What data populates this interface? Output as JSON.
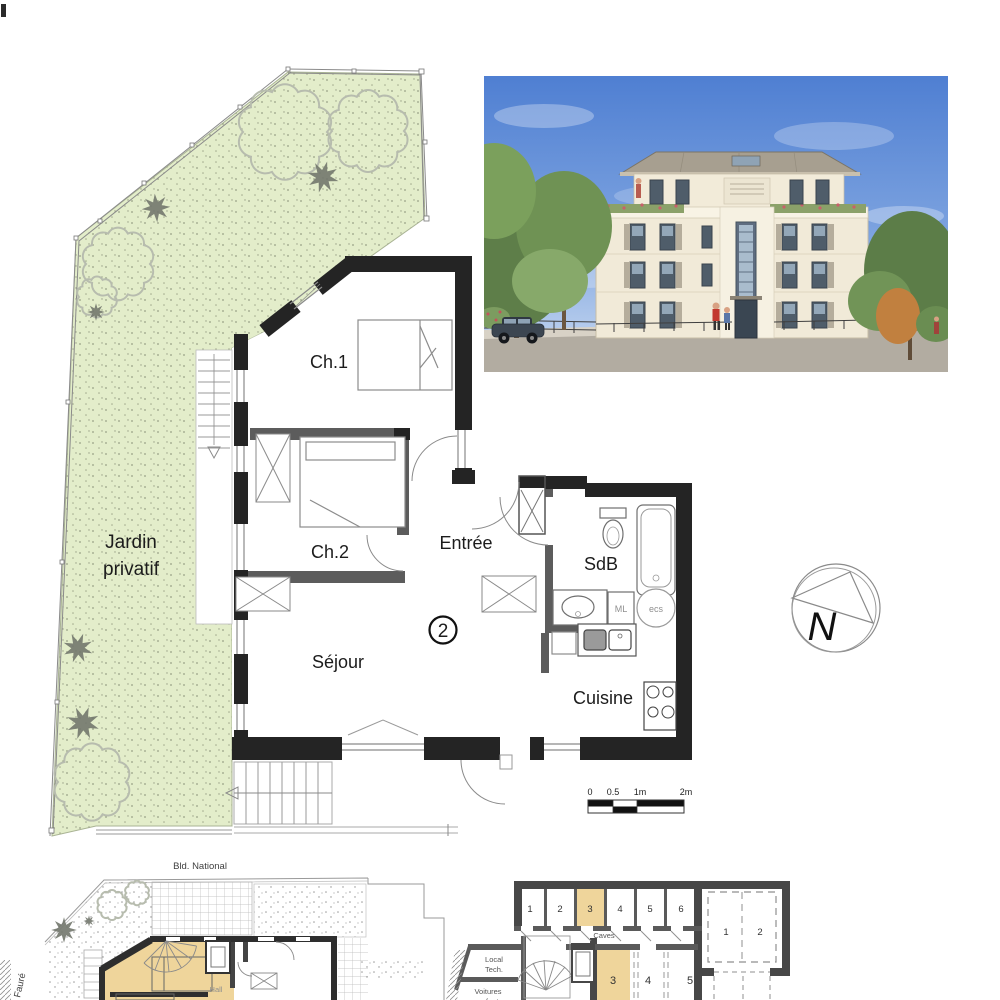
{
  "plan": {
    "rooms": {
      "ch1": "Ch.1",
      "ch2": "Ch.2",
      "entree": "Entrée",
      "sdb": "SdB",
      "sejour": "Séjour",
      "cuisine": "Cuisine"
    },
    "unit_number": "2",
    "garden": {
      "line1": "Jardin",
      "line2": "privatif"
    },
    "labels": {
      "ml": "ML",
      "ecs": "ecs"
    }
  },
  "compass": {
    "north": "N"
  },
  "scalebar": {
    "t0": "0",
    "t05": "0.5",
    "t1": "1m",
    "t2": "2m"
  },
  "ground_floor": {
    "street_top": "Bld. National",
    "street_left": "Fauré",
    "hall": "Hall"
  },
  "basement": {
    "caves_label": "Caves",
    "cave_numbers": [
      "1",
      "2",
      "3",
      "4",
      "5",
      "6"
    ],
    "garage_numbers": [
      "1",
      "2"
    ],
    "parking_numbers": [
      "3",
      "4",
      "5"
    ],
    "local_tech": [
      "Local",
      "Tech."
    ],
    "voitures": [
      "Voitures",
      "enfant"
    ]
  },
  "colors": {
    "garden_green": "#e3edca",
    "unit_highlight": "#efd59b"
  }
}
